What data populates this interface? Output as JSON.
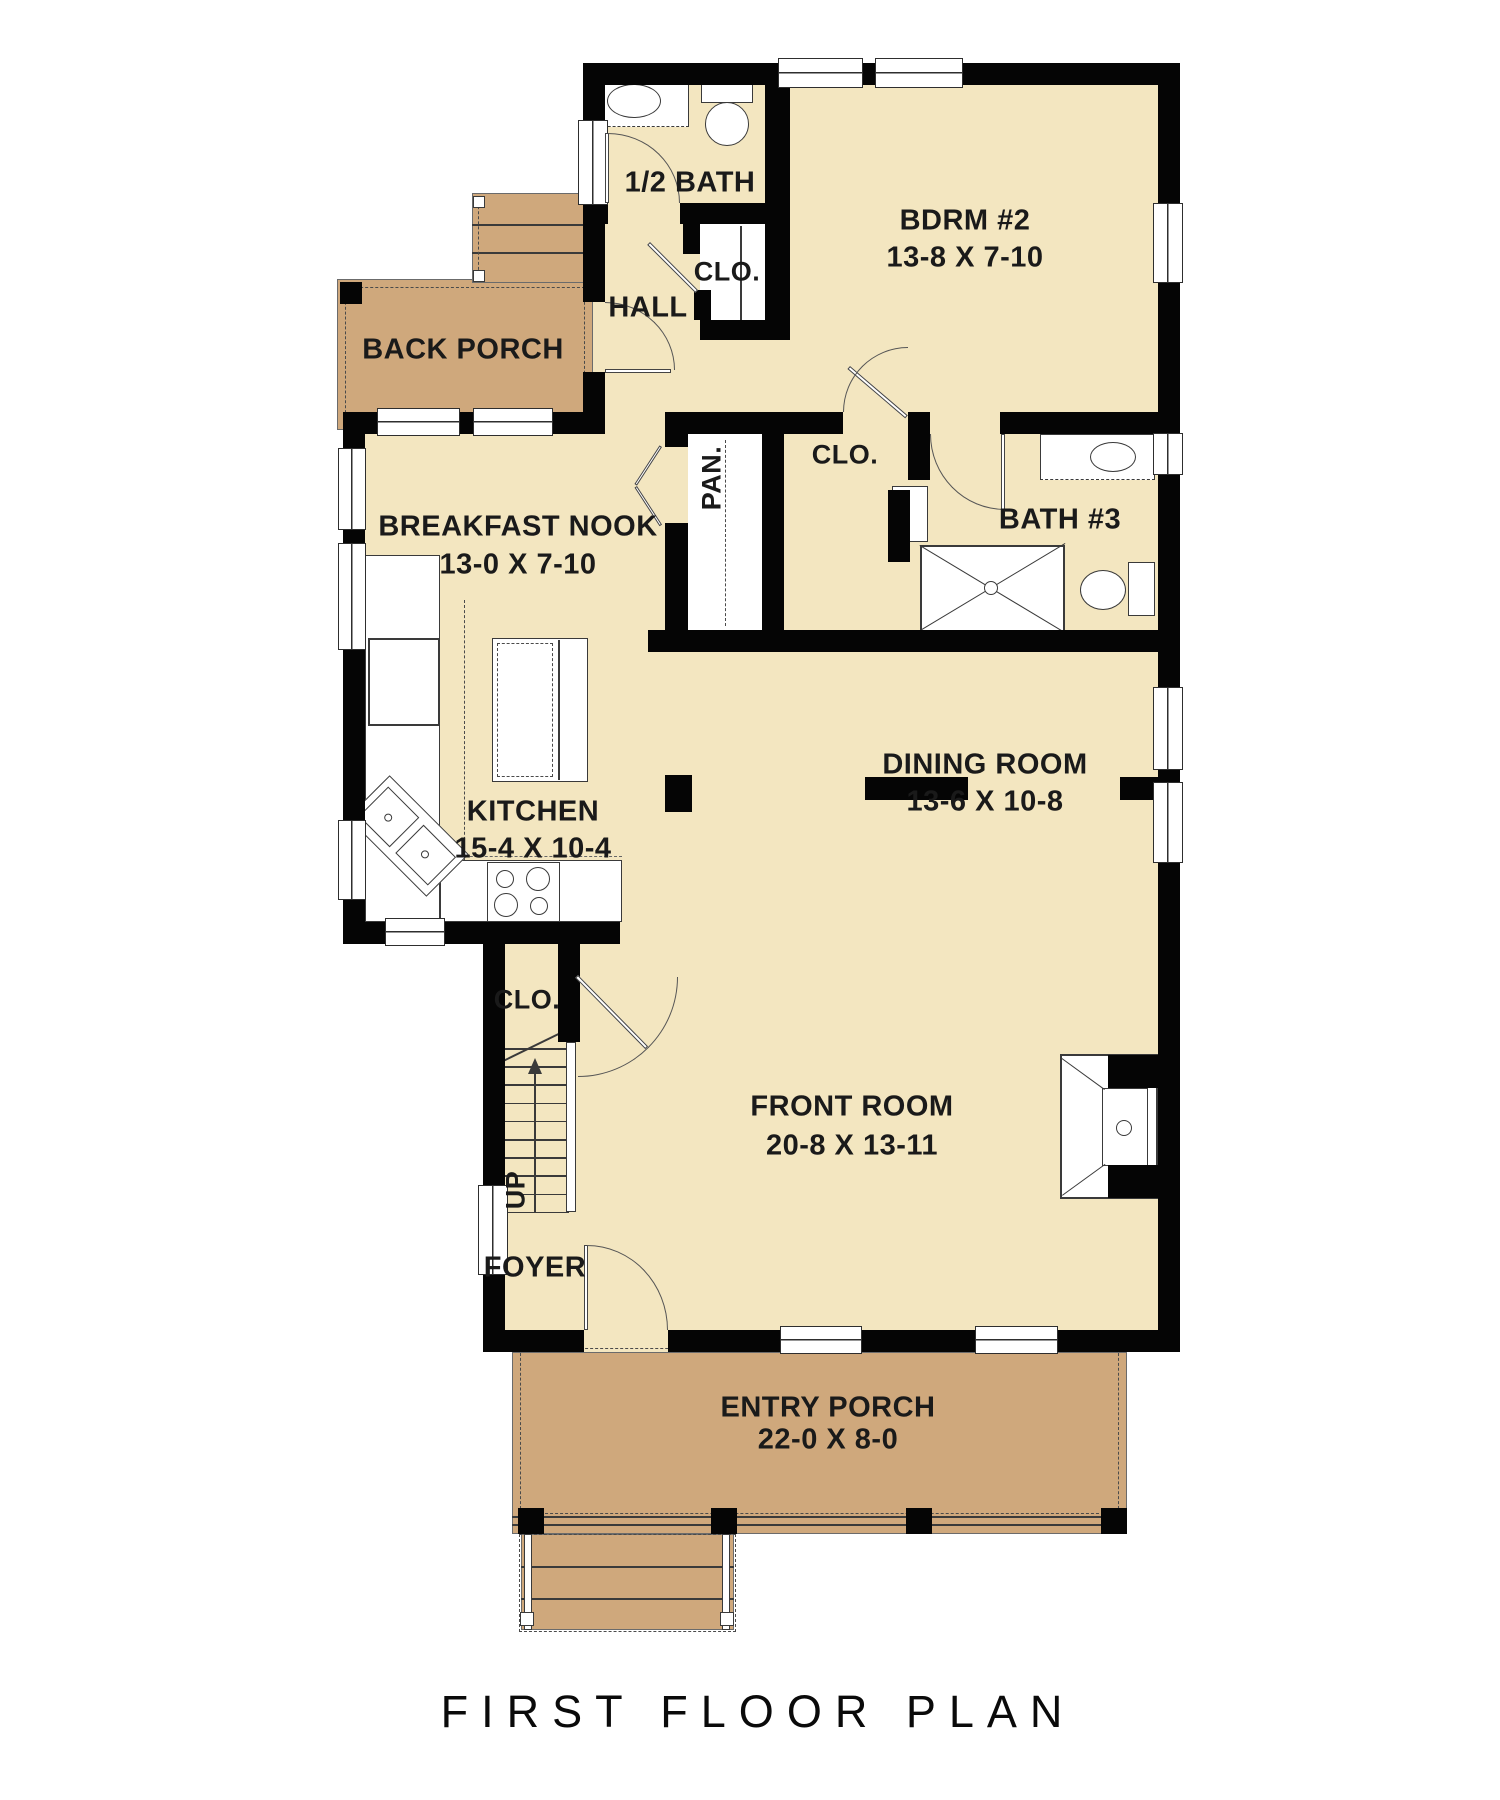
{
  "title": "FIRST FLOOR PLAN",
  "colors": {
    "floor": "#f3e6c0",
    "porch": "#cfa87c",
    "wall": "#050505",
    "ink": "#1a1a1a"
  },
  "rooms": {
    "half_bath": {
      "label": "1/2 BATH"
    },
    "hall": {
      "label": "HALL"
    },
    "hall_closet": {
      "label": "CLO."
    },
    "bdrm2": {
      "label": "BDRM #2",
      "dims": "13-8 X 7-10"
    },
    "back_porch": {
      "label": "BACK PORCH"
    },
    "breakfast_nook": {
      "label": "BREAKFAST NOOK",
      "dims": "13-0 X 7-10"
    },
    "pantry": {
      "label": "PAN."
    },
    "bath3_closet": {
      "label": "CLO."
    },
    "bath3": {
      "label": "BATH #3"
    },
    "kitchen": {
      "label": "KITCHEN",
      "dims": "15-4 X 10-4"
    },
    "dining": {
      "label": "DINING ROOM",
      "dims": "13-6 X 10-8"
    },
    "stairs_closet": {
      "label": "CLO."
    },
    "stairs": {
      "label": "UP"
    },
    "foyer": {
      "label": "FOYER"
    },
    "front_room": {
      "label": "FRONT ROOM",
      "dims": "20-8 X 13-11"
    },
    "entry_porch": {
      "label": "ENTRY PORCH",
      "dims": "22-0 X 8-0"
    }
  }
}
